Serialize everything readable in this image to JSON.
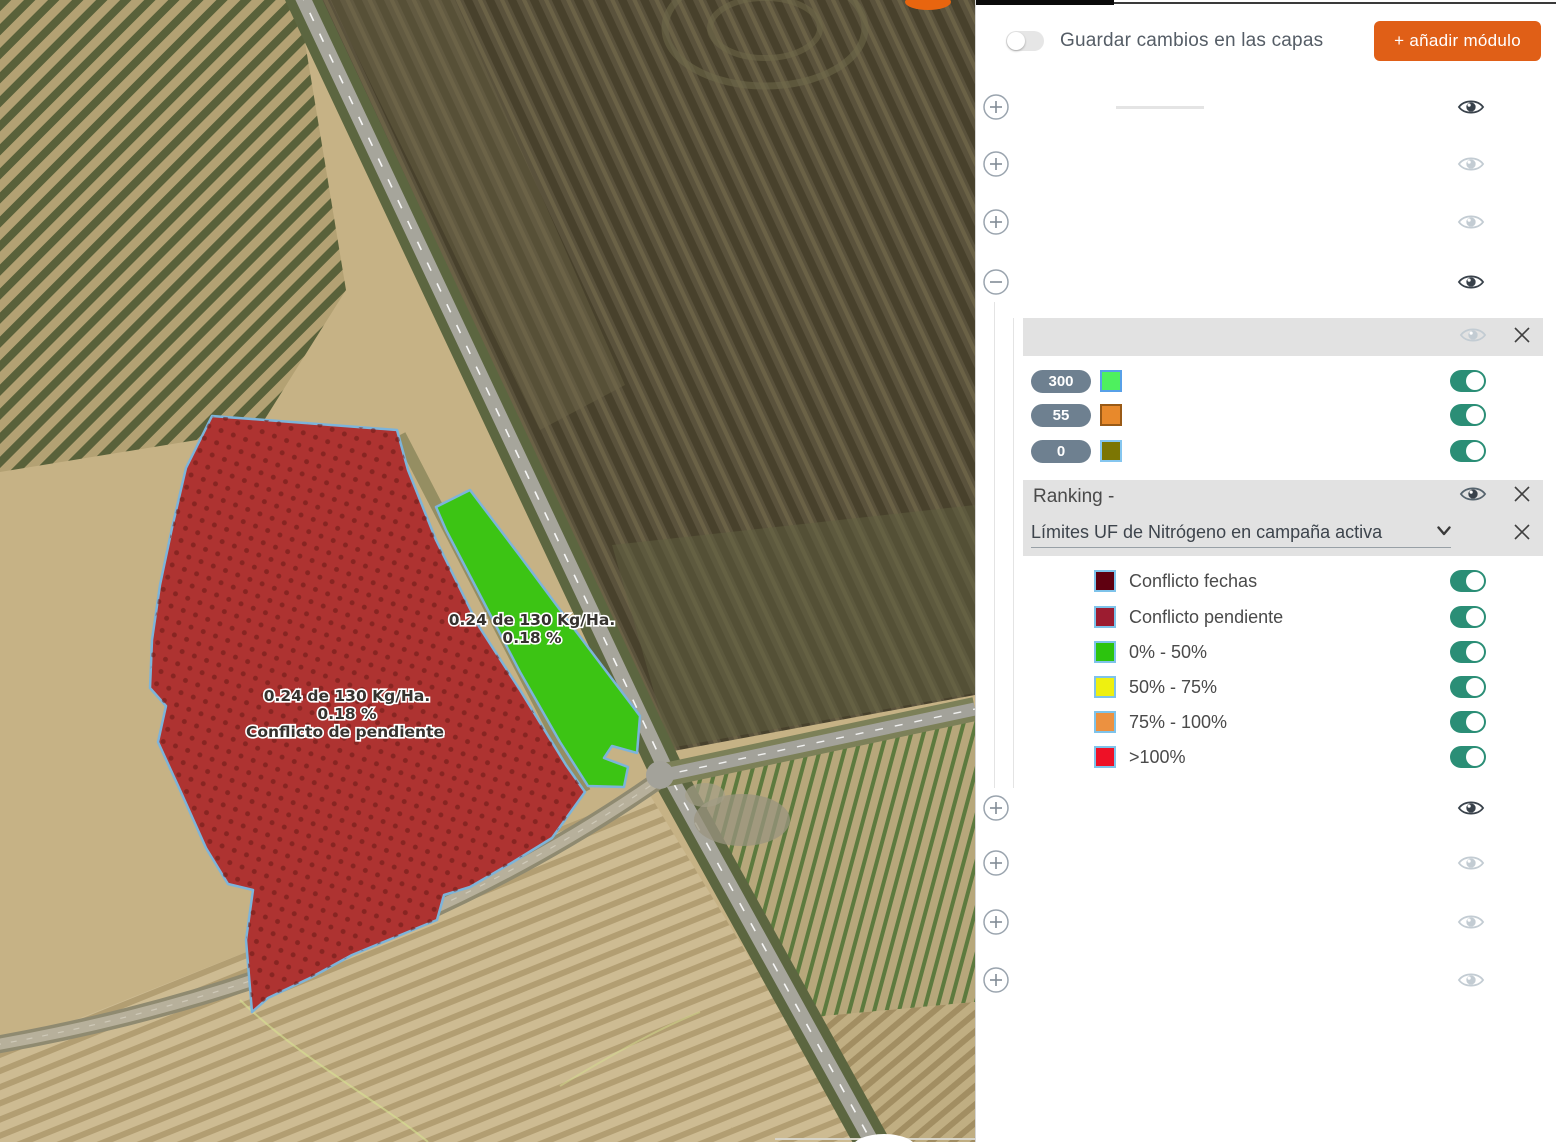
{
  "map": {
    "red_plot_label": {
      "line1": "0.24 de 130 Kg/Ha.",
      "line2": "0.18 %",
      "line3": "Conflicto de pendiente"
    },
    "green_plot_label": {
      "line1": "0.24 de 130 Kg/Ha.",
      "line2": "0.18 %"
    },
    "red_fill": "#ae3331",
    "green_fill": "#3cc414",
    "outline_blue": "#7db4da"
  },
  "panel": {
    "save_toggle": {
      "label": "Guardar cambios en las capas",
      "on": false
    },
    "add_module_button": {
      "label": "+ añadir módulo",
      "color": "#e05f17"
    },
    "toggle_on_color": "#2b8e76",
    "layers_top": [
      {
        "expander": "plus",
        "eye": "visible"
      },
      {
        "expander": "plus",
        "eye": "hidden"
      },
      {
        "expander": "plus",
        "eye": "hidden"
      },
      {
        "expander": "minus",
        "eye": "visible"
      }
    ],
    "module": {
      "header_eye": "hidden",
      "values": [
        {
          "badge": "300",
          "chip_color": "#4ef05e",
          "chip_border": "#57a0e8",
          "enabled": true
        },
        {
          "badge": "55",
          "chip_color": "#e8892b",
          "chip_border": "#9a5a16",
          "enabled": true
        },
        {
          "badge": "0",
          "chip_color": "#7c7603",
          "chip_border": "#85c6ef",
          "enabled": true
        }
      ],
      "ranking": {
        "label": "Ranking -"
      },
      "dropdown": {
        "value": "Límites UF de Nitrógeno en campaña activa"
      },
      "legend": [
        {
          "label": "Conflicto fechas",
          "color": "#5f0010",
          "enabled": true
        },
        {
          "label": "Conflicto pendiente",
          "color": "#9c1c30",
          "enabled": true
        },
        {
          "label": "0% - 50%",
          "color": "#2cc40e",
          "enabled": true
        },
        {
          "label": "50% - 75%",
          "color": "#eef010",
          "enabled": true
        },
        {
          "label": "75% - 100%",
          "color": "#ec9140",
          "enabled": true
        },
        {
          "label": ">100%",
          "color": "#ee1126",
          "enabled": true
        }
      ]
    },
    "layers_bottom": [
      {
        "expander": "plus",
        "eye": "visible"
      },
      {
        "expander": "plus",
        "eye": "hidden"
      },
      {
        "expander": "plus",
        "eye": "hidden"
      },
      {
        "expander": "plus",
        "eye": "hidden"
      }
    ]
  }
}
